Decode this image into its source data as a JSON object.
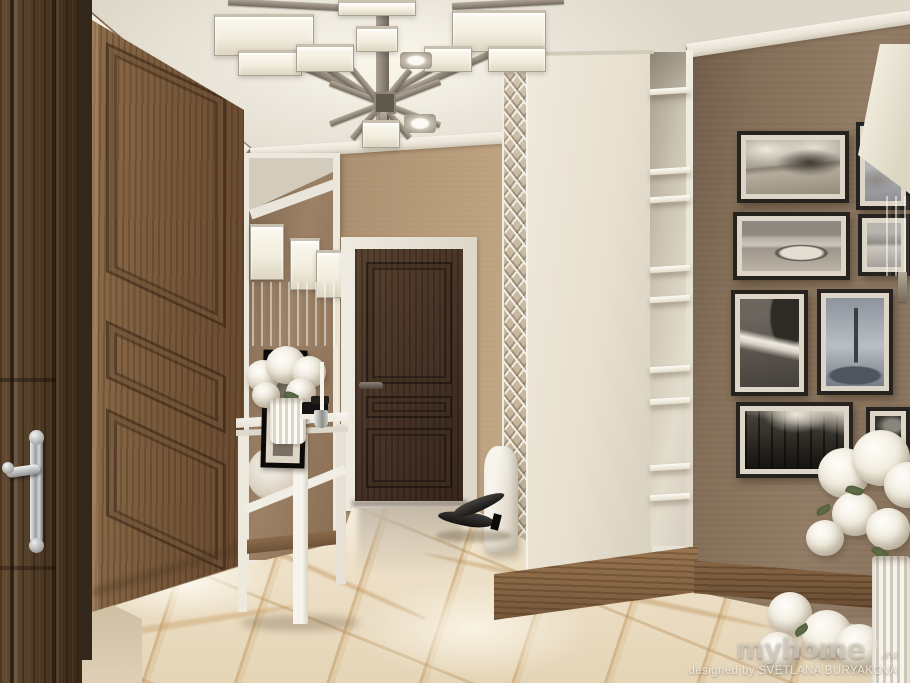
{
  "canvas": {
    "width": 910,
    "height": 683
  },
  "watermark": {
    "brand": "myhome",
    "domain_suffix": ".ru",
    "credit": "designed by SVETLANA BURYAKOVA"
  },
  "scene": {
    "type": "interior-design-3d-render",
    "room": "entrance-hallway",
    "objects": [
      "geometric-chrome-chandelier",
      "dark-wood-entry-door",
      "oak-paneled-door",
      "framed-wall-mirror",
      "crystal-wall-sconces",
      "white-console-table",
      "white-hydrangea-bouquet",
      "dark-brown-interior-door",
      "white-fretwork-screen",
      "cream-storage-cabinet",
      "open-display-shelves",
      "wood-plinth-baseboard",
      "black-and-white-photo-gallery",
      "white-lamp-shade-sconce",
      "beige-marble-floor",
      "black-high-heels",
      "foreground-white-flowers"
    ],
    "gallery_photos": [
      "country road under clouds",
      "tree branches",
      "rowboat on lake shore",
      "sea horizon",
      "rocky waterfall",
      "lone bare tree",
      "sunlit forest",
      "dark woodland"
    ],
    "palette": {
      "ceiling": "#ece7dc",
      "left_wall": "#a5896a",
      "right_wall": "#8d7861",
      "entry_door": "#4a3728",
      "oak_door": "#7a5a3c",
      "interior_door": "#463226",
      "cabinet": "#e7dfcf",
      "marble_base": "#ecdfc9",
      "marble_vein": "#c09a5e",
      "photo_frame": "#26221e",
      "metal": "#968e7f"
    }
  }
}
